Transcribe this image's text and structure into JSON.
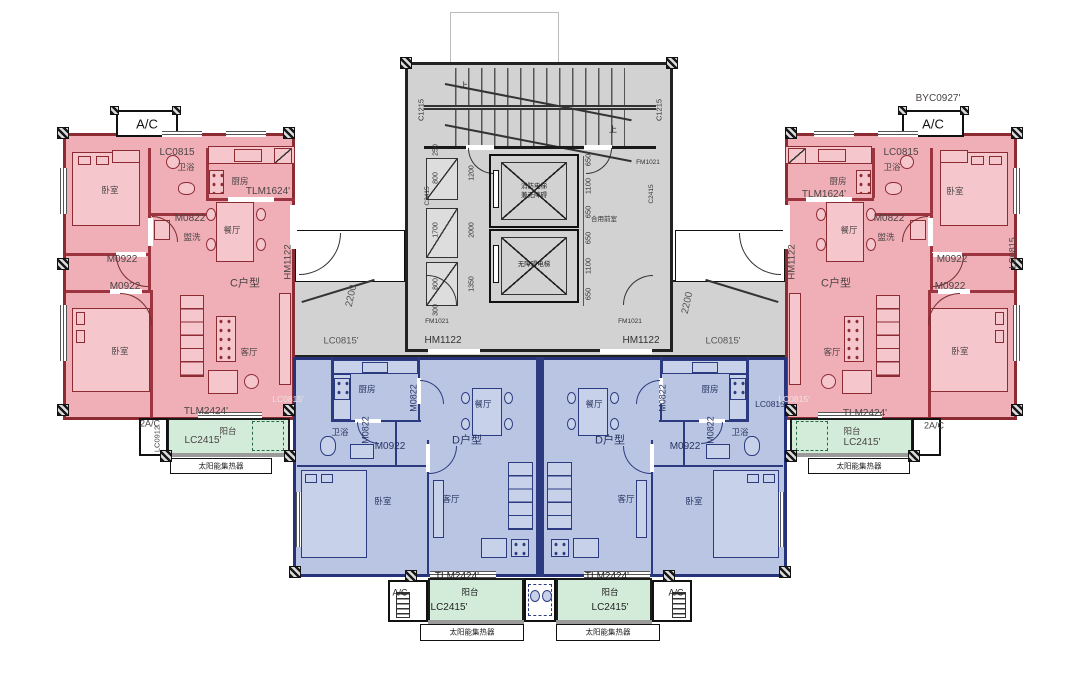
{
  "s": {
    "ac": "A/C",
    "ac2": "2A/C",
    "byc0927": "BYC0927'",
    "lc0815": "LC0815",
    "lc0815_m": "LC0815'",
    "lc0912": "LC0912",
    "lc2415": "LC2415'",
    "tlm1624": "TLM1624'",
    "tlm2424": "TLM2424'",
    "m0822": "M0822",
    "m0922": "M0922",
    "hm1122": "HM1122",
    "fm1021": "FM1021",
    "c1215": "C1215",
    "c2415": "C2415",
    "dim2200": "2200",
    "unit_c": "C户型",
    "unit_d": "D户型",
    "bedroom": "卧室",
    "living": "客厅",
    "dining": "餐厅",
    "kitchen": "厨房",
    "bath": "卫浴",
    "wash": "盥洗",
    "balcony": "阳台",
    "solar": "太阳能集热器",
    "lobby": "合用前室",
    "elev_fire_1": "消防电梯",
    "elev_fire_2": "兼无障碍",
    "elev_acc": "无障碍电梯",
    "up": "上",
    "dims_right": [
      "650",
      "1100",
      "650",
      "650",
      "1100",
      "650"
    ],
    "dims_left_outer": [
      "250",
      "800",
      "1700",
      "800",
      "300"
    ],
    "dims_left_inner": [
      "1200",
      "2000",
      "1350"
    ]
  },
  "colors": {
    "red_wall": "#8d2b33",
    "red_fill": "#f0aeb7",
    "blue_wall": "#26337b",
    "blue_fill": "#b9c5e2",
    "green_fill": "#d3ecd9",
    "core_gray": "#d2d2d2",
    "line": "#1a1a1a"
  }
}
